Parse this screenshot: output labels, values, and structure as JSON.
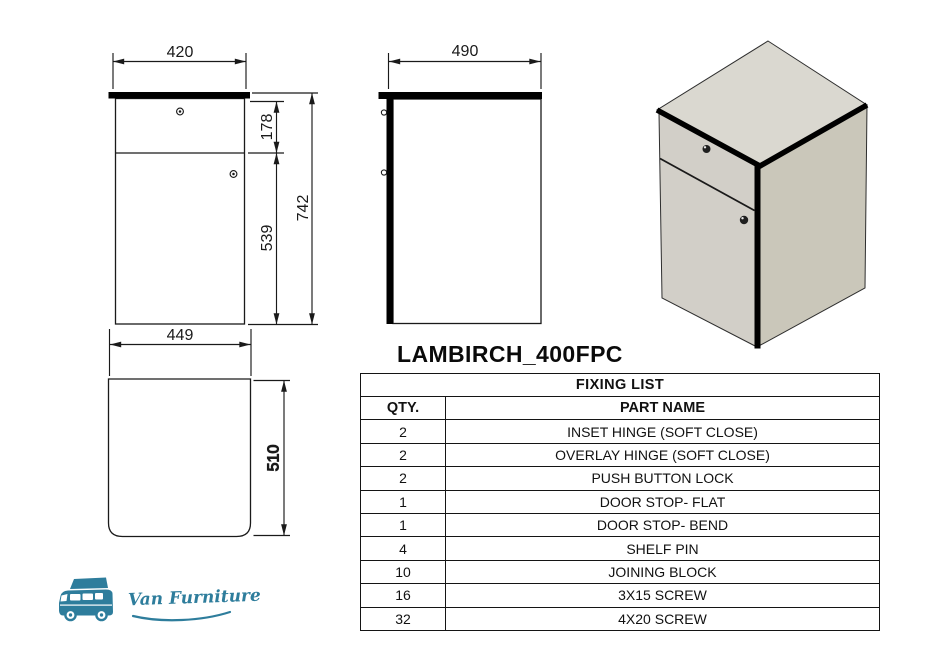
{
  "title": "LAMBIRCH_400FPC",
  "dimensions": {
    "front_width": "420",
    "drawer_height": "178",
    "door_height": "539",
    "total_height": "742",
    "top_width": "449",
    "side_depth": "490",
    "top_depth": "510"
  },
  "fixing_table": {
    "title": "FIXING LIST",
    "columns": {
      "qty": "QTY.",
      "part": "PART NAME"
    },
    "rows": [
      {
        "qty": "2",
        "part": "INSET HINGE (SOFT CLOSE)"
      },
      {
        "qty": "2",
        "part": "OVERLAY HINGE (SOFT CLOSE)"
      },
      {
        "qty": "2",
        "part": "PUSH BUTTON LOCK"
      },
      {
        "qty": "1",
        "part": "DOOR STOP- FLAT"
      },
      {
        "qty": "1",
        "part": "DOOR STOP- BEND"
      },
      {
        "qty": "4",
        "part": "SHELF PIN"
      },
      {
        "qty": "10",
        "part": "JOINING BLOCK"
      },
      {
        "qty": "16",
        "part": "3X15 SCREW"
      },
      {
        "qty": "32",
        "part": "4X20 SCREW"
      }
    ]
  },
  "logo": {
    "brand": "Van Furniture",
    "color": "#2e7d9c"
  },
  "drawing_colors": {
    "line": "#1a1a1a",
    "face_top": "#dad8d0",
    "face_front": "#d2cfc8",
    "face_side": "#cac7ba"
  }
}
